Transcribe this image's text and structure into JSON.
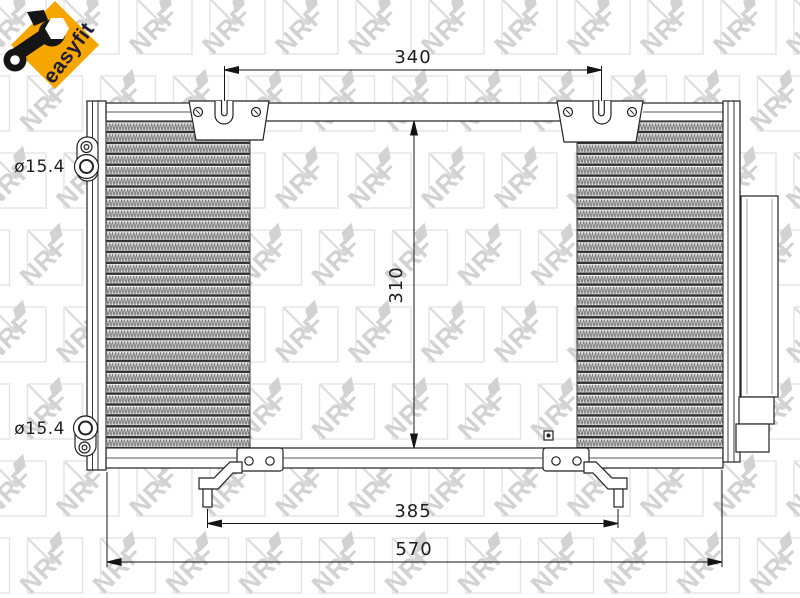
{
  "page": {
    "background": "#ffffff"
  },
  "watermark": {
    "text": "NRF",
    "color": "#c7c7c7"
  },
  "logo": {
    "label": "easyfit",
    "diamond_color": "#f7a600",
    "label_color": "#1c1c38"
  },
  "dimensions": {
    "mount_width": {
      "label": "340"
    },
    "core_height": {
      "label": "310"
    },
    "feet_span": {
      "label": "385"
    },
    "core_width": {
      "label": "570"
    },
    "upper_port": {
      "label": "ø15.4"
    },
    "lower_port": {
      "label": "ø15.4"
    }
  }
}
